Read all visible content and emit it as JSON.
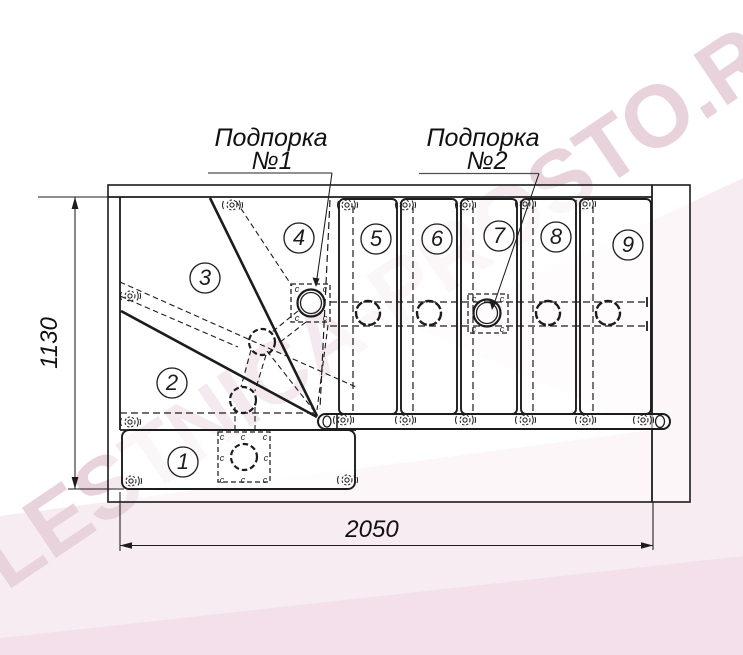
{
  "colors": {
    "line": "#1c1c1c",
    "underline": "#4f4f4f",
    "watermark": "#e8d2dc",
    "pink_light": "#f8ecf3",
    "pink_mid": "#f3e0eb",
    "paper": "#ffffff"
  },
  "watermark": {
    "text": "LESTNICA-PROSTO.RU"
  },
  "annotations": {
    "support1": {
      "title": "Подпорка",
      "number": "№1"
    },
    "support2": {
      "title": "Подпорка",
      "number": "№2"
    }
  },
  "dimensions": {
    "height_mm": "1130",
    "width_mm": "2050"
  },
  "steps": [
    "1",
    "2",
    "3",
    "4",
    "5",
    "6",
    "7",
    "8",
    "9"
  ],
  "marks": {
    "connector": "c"
  }
}
